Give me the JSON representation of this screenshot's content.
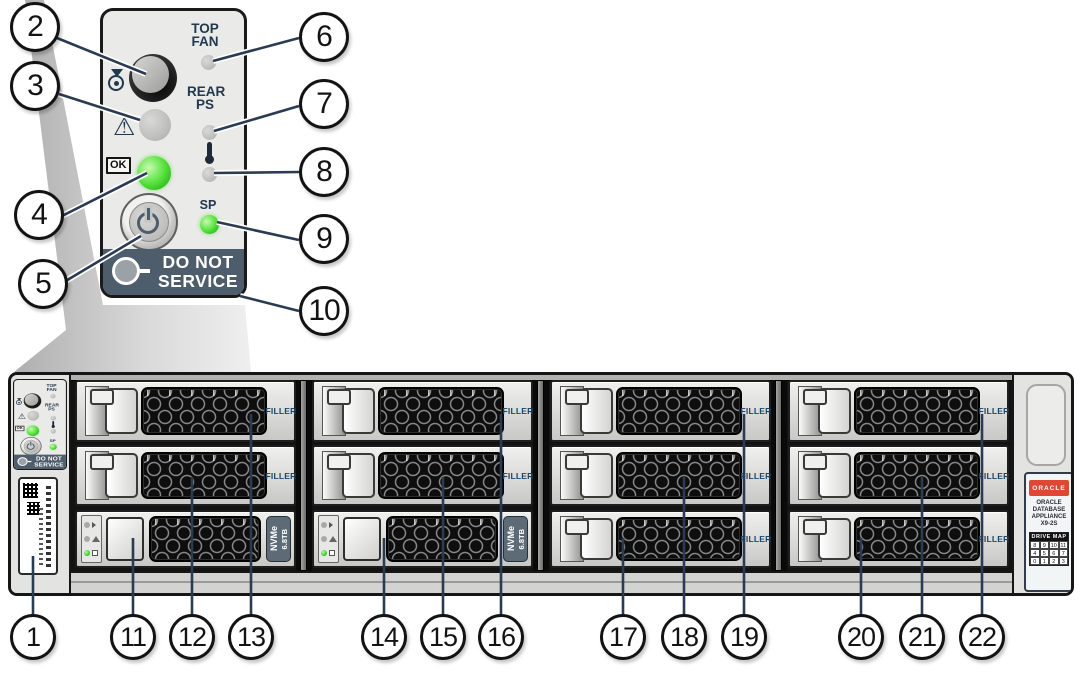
{
  "panel": {
    "top_fan_1": "TOP",
    "top_fan_2": "FAN",
    "rear_ps_1": "REAR",
    "rear_ps_2": "PS",
    "sp": "SP",
    "ok": "OK",
    "do_not_1": "DO NOT",
    "do_not_2": "SERVICE"
  },
  "chassis": {
    "groups": [
      {
        "rows": [
          {
            "type": "filler",
            "label": "FILLER"
          },
          {
            "type": "filler",
            "label": "FILLER"
          },
          {
            "type": "drive",
            "drive_type": "NVMe",
            "capacity": "6.8TB"
          }
        ]
      },
      {
        "rows": [
          {
            "type": "filler",
            "label": "FILLER"
          },
          {
            "type": "filler",
            "label": "FILLER"
          },
          {
            "type": "drive",
            "drive_type": "NVMe",
            "capacity": "6.8TB"
          }
        ]
      },
      {
        "rows": [
          {
            "type": "filler",
            "label": "FILLER"
          },
          {
            "type": "filler",
            "label": "FILLER"
          },
          {
            "type": "filler",
            "label": "FILLER"
          }
        ]
      },
      {
        "rows": [
          {
            "type": "filler",
            "label": "FILLER"
          },
          {
            "type": "filler",
            "label": "FILLER"
          },
          {
            "type": "filler",
            "label": "FILLER"
          }
        ]
      }
    ],
    "oracle_label": {
      "brand": "ORACLE",
      "product": [
        "ORACLE",
        "DATABASE",
        "APPLIANCE",
        "X9-2S"
      ],
      "drive_map_title": "DRIVE MAP",
      "drive_map": [
        [
          "8",
          "9",
          "10",
          "11"
        ],
        [
          "4",
          "5",
          "6",
          "7"
        ],
        [
          "0",
          "1",
          "2",
          "3"
        ]
      ]
    }
  },
  "callouts": {
    "c1": "1",
    "c2": "2",
    "c3": "3",
    "c4": "4",
    "c5": "5",
    "c6": "6",
    "c7": "7",
    "c8": "8",
    "c9": "9",
    "c10": "10",
    "c11": "11",
    "c12": "12",
    "c13": "13",
    "c14": "14",
    "c15": "15",
    "c16": "16",
    "c17": "17",
    "c18": "18",
    "c19": "19",
    "c20": "20",
    "c21": "21",
    "c22": "22"
  },
  "colors": {
    "callout_line": "#2a3b52",
    "panel_text": "#22384e",
    "led_green": "#57e23e",
    "led_gray": "#b9b9b7",
    "do_not_service_band": "#4d5d6b",
    "filler_text": "#1c4668",
    "oracle_red": "#dd4733",
    "nvme_tab": "#5c6b76"
  }
}
